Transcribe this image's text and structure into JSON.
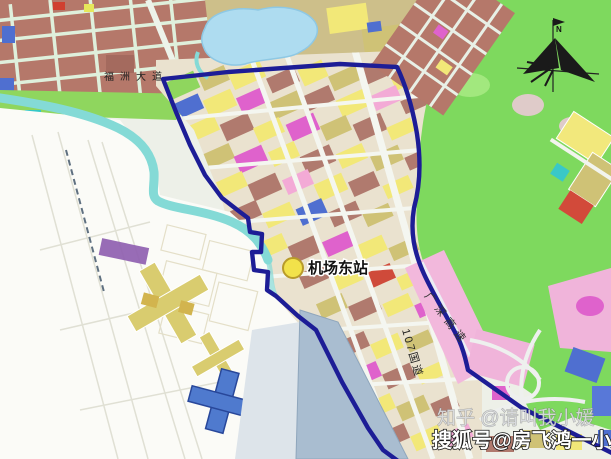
{
  "map": {
    "kind": "urban-planning-zoning-map",
    "labels": {
      "road_top": "福洲大道",
      "station": "机场东站",
      "expressway": "广深高速",
      "national_road": "107国道",
      "compass_north": "N"
    },
    "watermarks": [
      {
        "text": "知乎 @请叫我小媛"
      },
      {
        "text": "搜狐号@房飞鸿一小媛"
      }
    ],
    "colors": {
      "boundary_line": "#1d1d96",
      "green_hills": "#7ed95e",
      "lake": "#aedcf0",
      "river": "#84dad6",
      "water_channel": "#a9bdd0",
      "urban_maroon": "#b5786a",
      "parcel_yellow": "#f2e878",
      "parcel_khaki": "#cfc276",
      "parcel_magenta": "#df62cc",
      "parcel_pink": "#f3aad6",
      "parcel_blue": "#4f6fd0",
      "parcel_red": "#d04838",
      "expressway_band": "#f2b8dc",
      "station_marker": "#f2e24a",
      "airport_ground": "#fbfbf7"
    }
  }
}
